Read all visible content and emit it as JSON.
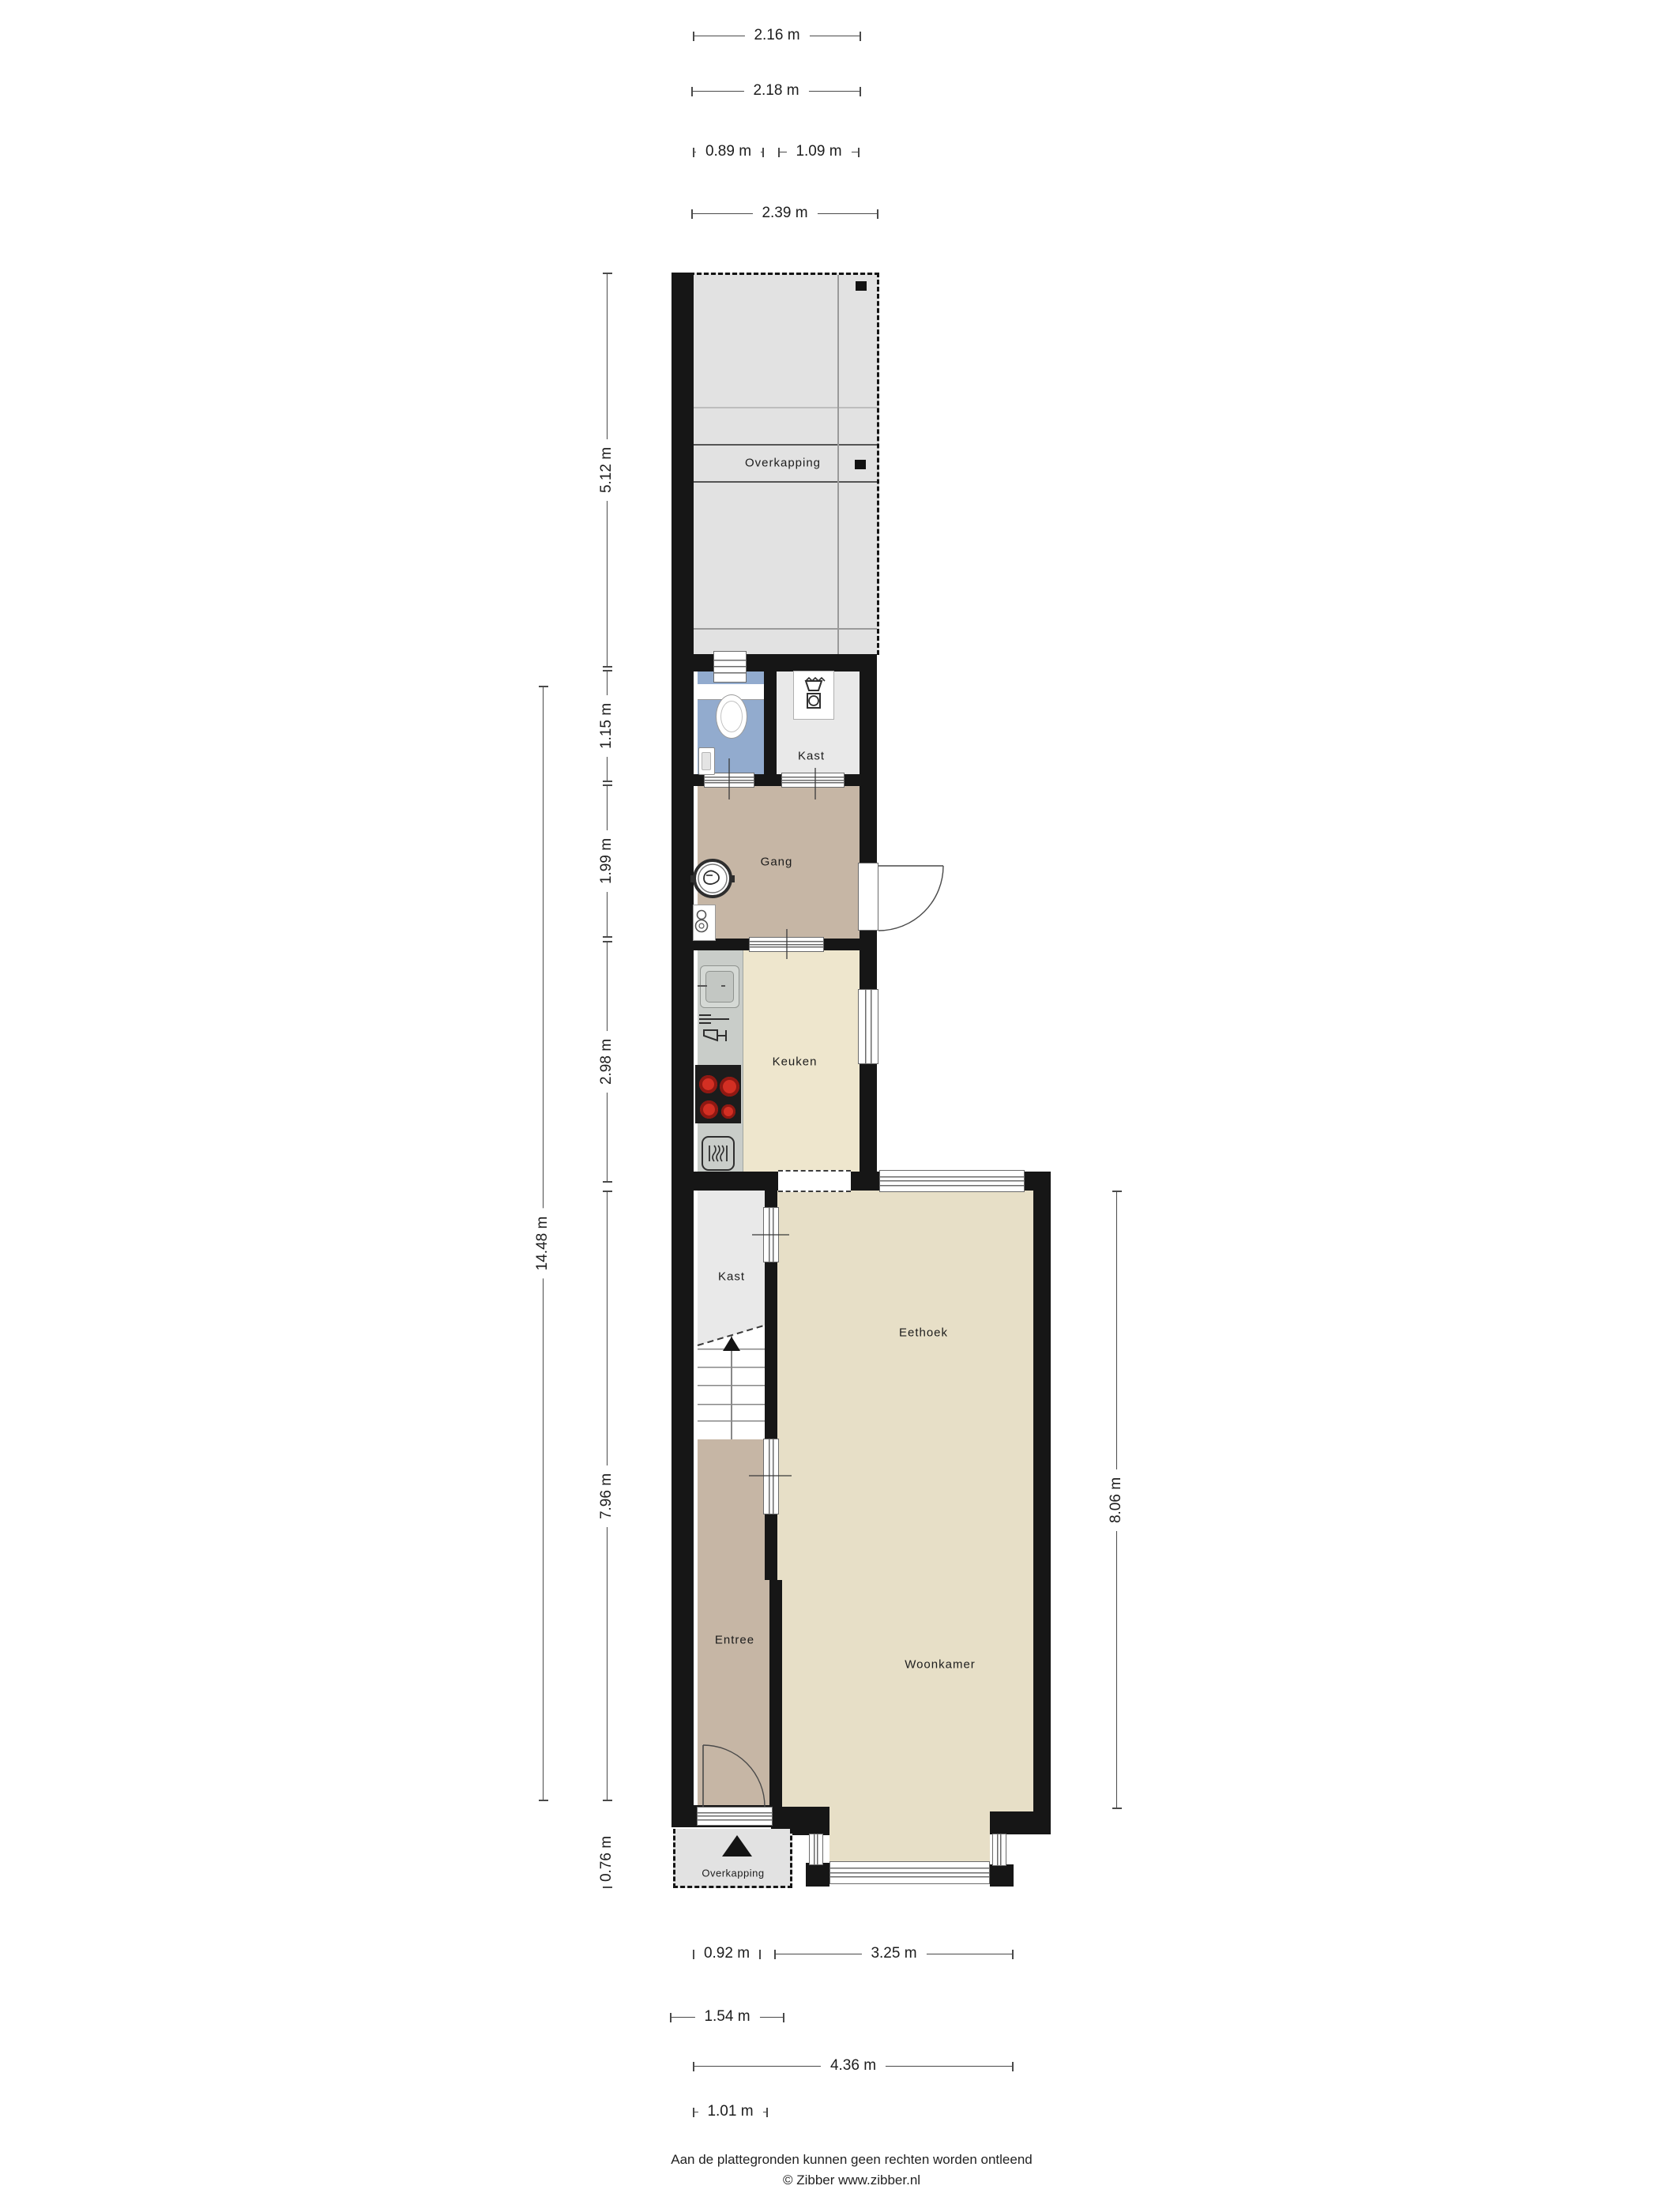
{
  "rooms": {
    "overkapping_top": "Overkapping",
    "kast_top": "Kast",
    "gang": "Gang",
    "keuken": "Keuken",
    "kast_mid": "Kast",
    "eethoek": "Eethoek",
    "entree": "Entree",
    "woonkamer": "Woonkamer",
    "overkapping_bottom": "Overkapping"
  },
  "dimensions": {
    "top": [
      "2.16 m",
      "2.18 m",
      "0.89 m",
      "1.09 m",
      "2.39 m"
    ],
    "left": [
      "5.12 m",
      "1.15 m",
      "1.99 m",
      "2.98 m",
      "14.48 m",
      "7.96 m",
      "0.76 m"
    ],
    "right": [
      "8.06 m"
    ],
    "bottom": [
      "0.92 m",
      "3.25 m",
      "1.54 m",
      "4.36 m",
      "1.01 m"
    ]
  },
  "footer": {
    "disclaimer": "Aan de plattegronden kunnen geen rechten worden ontleend",
    "credit": "© Zibber www.zibber.nl"
  },
  "icons": {
    "toilet": "toilet-icon",
    "sink_small": "hand-basin-icon",
    "washer": "washing-machine-icon",
    "laundry_basket": "laundry-basket-icon",
    "boiler": "central-heating-boiler-icon",
    "meter_cabinet": "meter-cabinet-icon",
    "kitchen_sink": "kitchen-sink-icon",
    "dishwasher": "dishwasher-icon",
    "hob": "cooktop-icon",
    "oven": "oven-icon",
    "stairs": "staircase-up-icon",
    "entrance_arrow": "entrance-arrow-icon"
  },
  "colors": {
    "wall": "#161616",
    "floor_hall": "#c6b6a5",
    "floor_kitchen": "#eee6cd",
    "floor_living": "#e7dfc7",
    "floor_closet": "#e9e9e9",
    "floor_toilet": "#92abce",
    "floor_canopy": "#e2e2e2",
    "counter": "#c9cdc9",
    "burner_red": "#d32f23"
  }
}
